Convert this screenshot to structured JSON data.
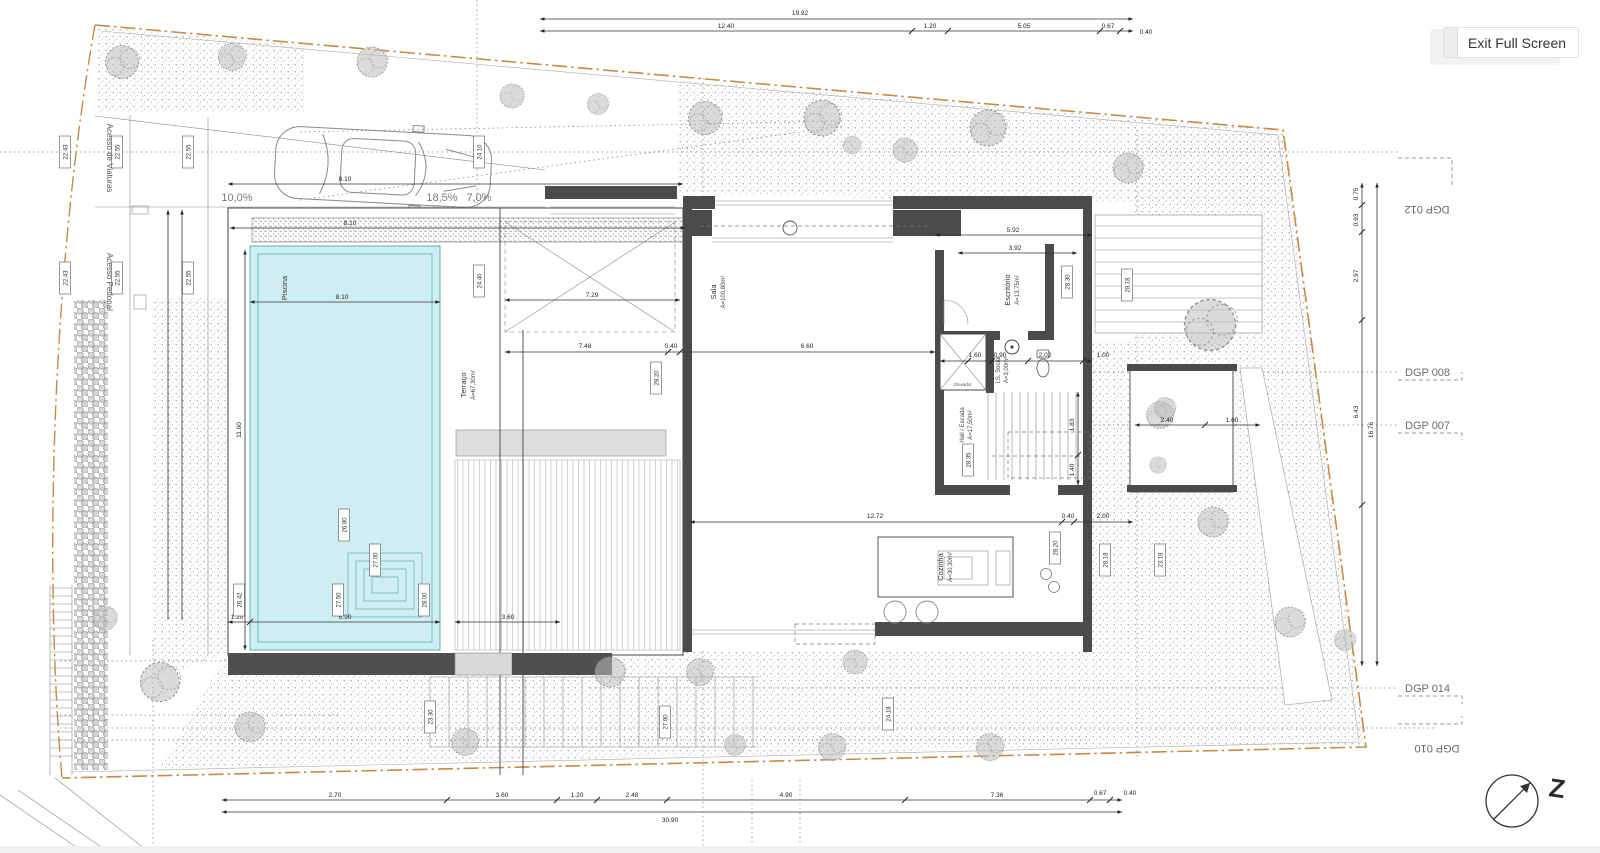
{
  "ui": {
    "exit_button_label": "Exit Full Screen"
  },
  "colors": {
    "pool_fill": "#cfeef2",
    "boundary": "#c98a45",
    "wall": "#4b4b4b"
  },
  "compass": {
    "north_label": "Z"
  },
  "access": {
    "vehicles": "Acesso de Viaturas",
    "pedestrian": "Acesso Pedonal"
  },
  "ramps": [
    "10,0%",
    "18,5%",
    "7,0%"
  ],
  "dgp": [
    "DGP 012",
    "DGP 008",
    "DGP 007",
    "DGP 014",
    "DGP 010"
  ],
  "rooms": {
    "piscina": {
      "name": "Piscina"
    },
    "terraco": {
      "name": "Terraço",
      "area": "A=67,30m²"
    },
    "sala": {
      "name": "Sala",
      "area": "A=100,80m²"
    },
    "escritorio": {
      "name": "Escritório",
      "area": "A=13,75m²"
    },
    "is_social": {
      "name": "I.S. Social",
      "area": "A=3,00m²"
    },
    "hall": {
      "name": "Hall / Escada",
      "area": "A=17,50m²"
    },
    "cozinha": {
      "name": "Cozinha",
      "area": "A=30,30m²"
    },
    "elevador": {
      "name": "Elevador"
    }
  },
  "levels": [
    "22.43",
    "22.55",
    "22.55",
    "22.43",
    "22.55",
    "22.55",
    "24.10",
    "24.40",
    "26.80",
    "27.50",
    "28.00",
    "27.00",
    "28.20",
    "28.30",
    "28.18",
    "28.35",
    "28.20",
    "28.18",
    "23.30",
    "27.80",
    "24.18",
    "23.18",
    "26.42"
  ],
  "dims": {
    "top": {
      "overall": "19.92",
      "segs": [
        "12.40",
        "1.20",
        "5.05",
        "0.67",
        "0.40"
      ]
    },
    "bottom": {
      "overall": "30.90",
      "segs": [
        "2.70",
        "3.60",
        "1.20",
        "2.48",
        "4.90",
        "7.36",
        "0.67",
        "0.40"
      ]
    },
    "right": {
      "overall": "16.76",
      "segs": [
        "0.75",
        "0.93",
        "2.97",
        "6.43"
      ]
    },
    "terrace": [
      "7.48",
      "0.40",
      "6.60"
    ],
    "upper_terrace": "7.29",
    "kitchen": [
      "12.72",
      "0.40",
      "2.00"
    ],
    "drive": "8.10",
    "pool": [
      "8.10",
      "8.10",
      "11.60",
      "6.90",
      "1.20",
      "3.60"
    ],
    "small": [
      "1.60",
      "0.90",
      "2.02",
      "1.00",
      "3.92",
      "5.92",
      "1.83",
      "1.40",
      "2.40",
      "1.60"
    ]
  }
}
